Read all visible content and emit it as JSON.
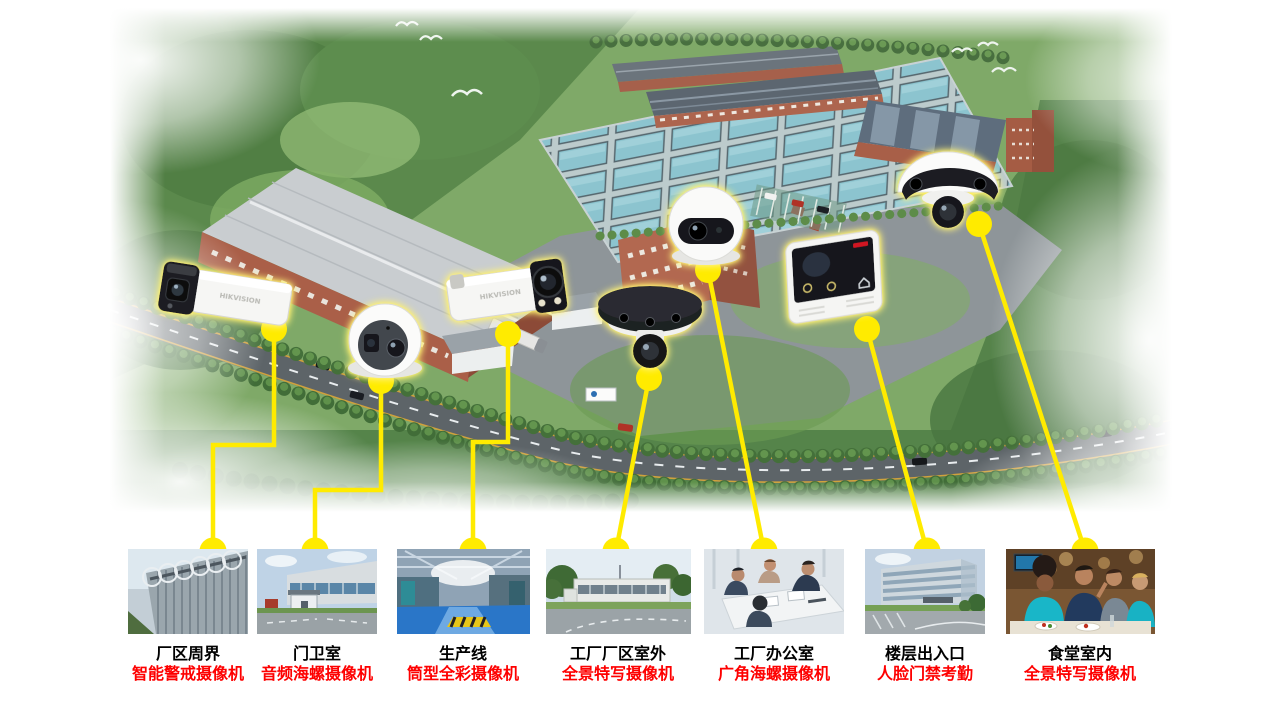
{
  "slide": {
    "brand": "HIKVISION",
    "connector_color": "#ffeb00",
    "location_label_color": "#000000",
    "camera_label_color": "#fe0000"
  },
  "items": [
    {
      "location": "厂区周界",
      "camera": "智能警戒摄像机",
      "icon": "bullet-alarm-camera-icon",
      "thumbnail": "perimeter-fence-photo"
    },
    {
      "location": "门卫室",
      "camera": "音频海螺摄像机",
      "icon": "audio-turret-camera-icon",
      "thumbnail": "guard-house-photo"
    },
    {
      "location": "生产线",
      "camera": "筒型全彩摄像机",
      "icon": "colorvu-bullet-camera-icon",
      "thumbnail": "production-line-photo"
    },
    {
      "location": "工厂厂区室外",
      "camera": "全景特写摄像机",
      "icon": "panoramic-multisensor-camera-icon",
      "thumbnail": "factory-outdoor-photo"
    },
    {
      "location": "工厂办公室",
      "camera": "广角海螺摄像机",
      "icon": "wide-angle-turret-camera-icon",
      "thumbnail": "factory-office-photo"
    },
    {
      "location": "楼层出入口",
      "camera": "人脸门禁考勤",
      "icon": "face-access-terminal-icon",
      "thumbnail": "floor-entrance-photo"
    },
    {
      "location": "食堂室内",
      "camera": "全景特写摄像机",
      "icon": "panoramic-ptz-dome-camera-icon",
      "thumbnail": "canteen-photo"
    }
  ]
}
